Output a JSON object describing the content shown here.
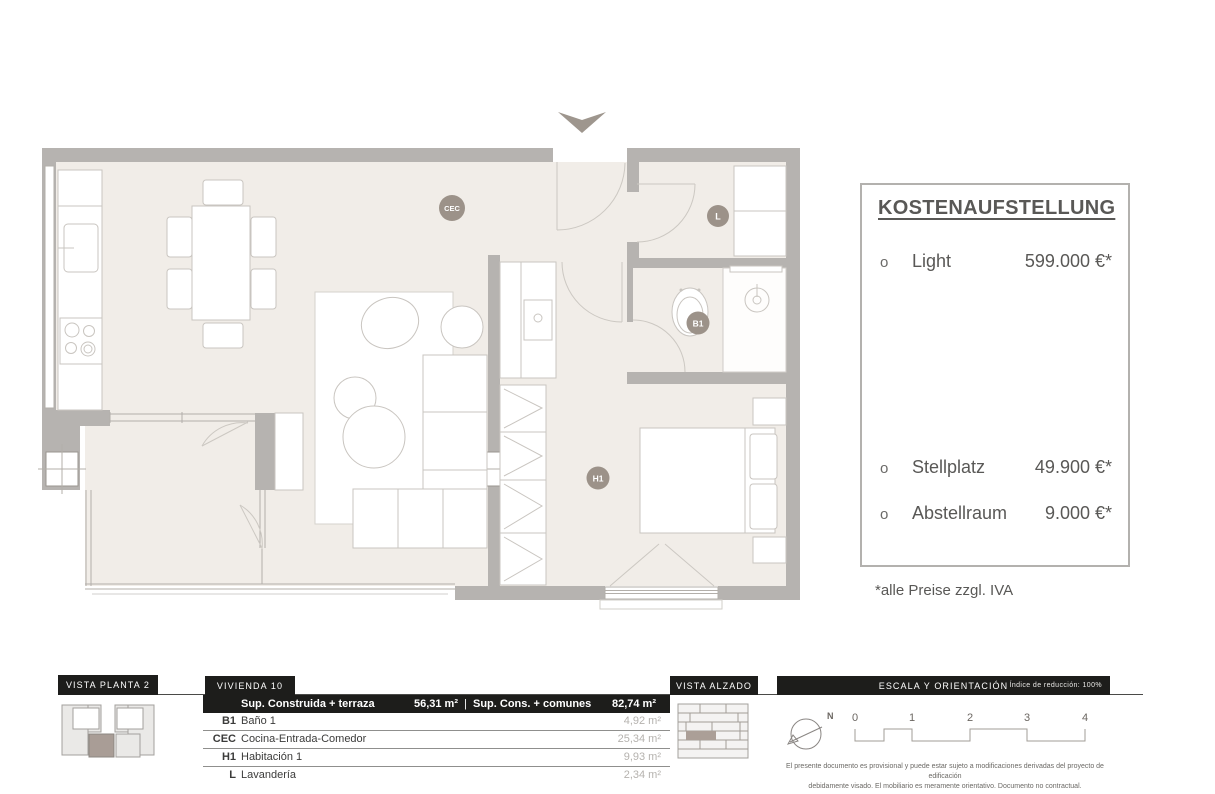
{
  "plan": {
    "room_labels": [
      {
        "code": "CEC"
      },
      {
        "code": "L"
      },
      {
        "code": "B1"
      },
      {
        "code": "H1"
      }
    ]
  },
  "cost_panel": {
    "title": "KOSTENAUFSTELLUNG",
    "items": [
      {
        "bullet": "o",
        "label": "Light",
        "price": "599.000 €*"
      },
      {
        "bullet": "o",
        "label": "Stellplatz",
        "price": "49.900 €*"
      },
      {
        "bullet": "o",
        "label": "Abstellraum",
        "price": "9.000 €*"
      }
    ],
    "footnote": "*alle Preise zzgl. IVA"
  },
  "footer": {
    "vista_planta_label": "VISTA PLANTA 2",
    "vivienda_label": "VIVIENDA 10",
    "vista_alzado_label": "VISTA ALZADO",
    "escala_label": "ESCALA Y ORIENTACIÓN",
    "indice_label": "Índice de reducción: 100%",
    "table": {
      "header": {
        "col1": "Sup. Construida + terraza",
        "val1": "56,31 m²",
        "sep": "|",
        "col2": "Sup. Cons. + comunes",
        "val2": "82,74 m²"
      },
      "rows": [
        {
          "code": "B1",
          "name": "Baño 1",
          "area": "4,92 m²"
        },
        {
          "code": "CEC",
          "name": "Cocina-Entrada-Comedor",
          "area": "25,34 m²"
        },
        {
          "code": "H1",
          "name": "Habitación 1",
          "area": "9,93 m²"
        },
        {
          "code": "L",
          "name": "Lavandería",
          "area": "2,34 m²"
        }
      ]
    },
    "compass_n": "N",
    "scale_ticks": [
      "0",
      "1",
      "2",
      "3",
      "4"
    ],
    "disclaimer_line1": "El presente documento es provisional y puede estar sujeto a modificaciones derivadas del proyecto de edificación",
    "disclaimer_line2": "debidamente visado. El mobiliario es meramente orientativo. Documento no contractual."
  },
  "colors": {
    "wall": "#b6b3b0",
    "floor": "#f1ede8",
    "accent_black": "#1d1d1b",
    "label_circle": "#9c9289",
    "highlight_unit": "#a99d96"
  }
}
